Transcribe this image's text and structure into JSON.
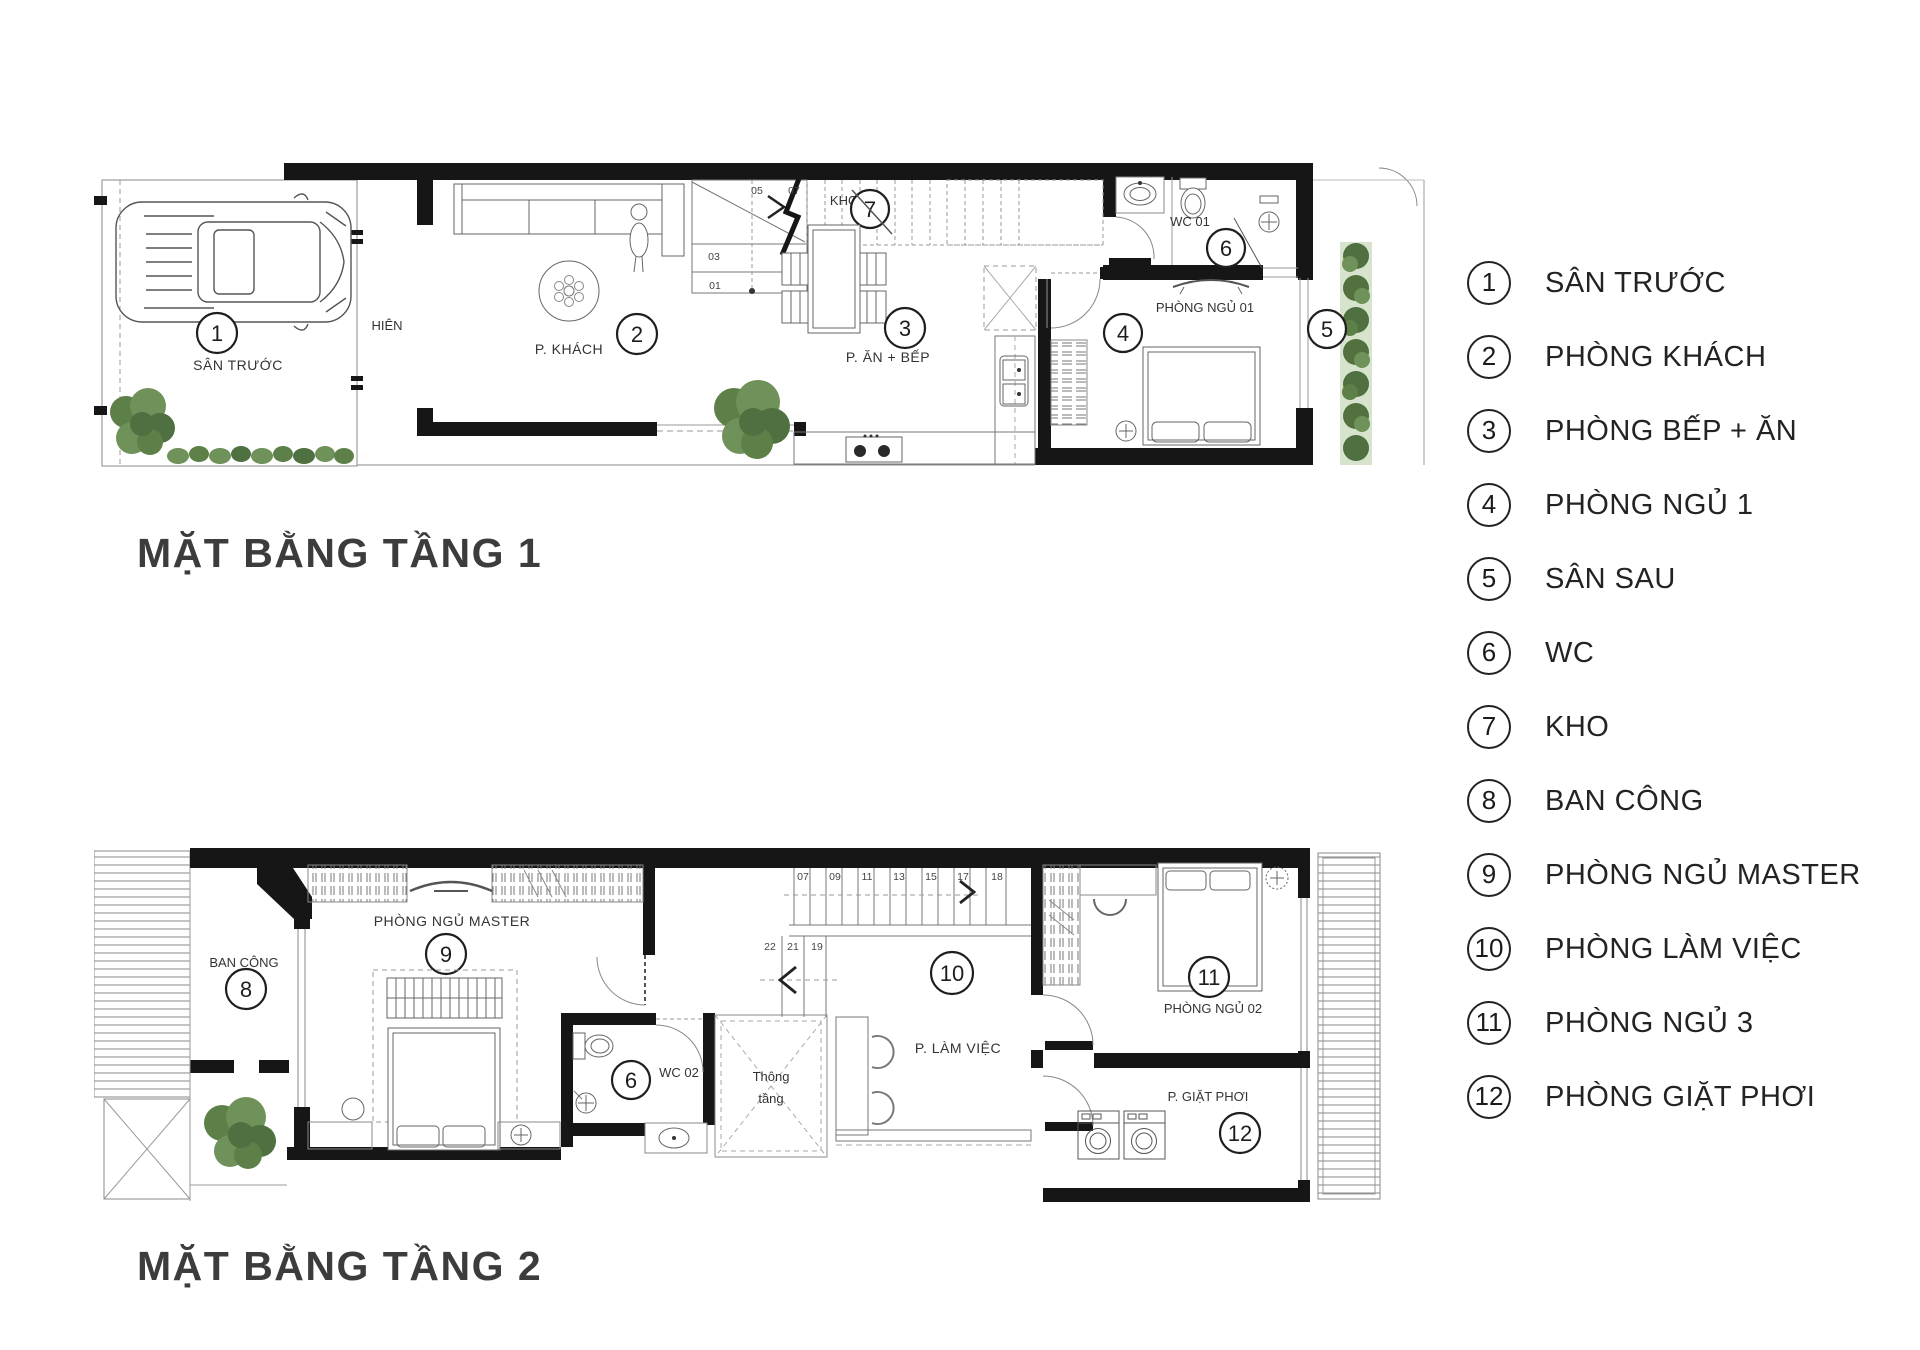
{
  "page": {
    "background": "#ffffff"
  },
  "colors": {
    "wall": "#161616",
    "line": "#6b6b6b",
    "plant_dark": "#4f7040",
    "plant_mid": "#5d8048",
    "plant_light": "#6f915a",
    "band": "#d8e3cd",
    "text": "#2f2f2f"
  },
  "floor1": {
    "title": "MẶT BẰNG TẦNG 1",
    "rooms": {
      "san_truoc": {
        "num": "1",
        "label": "SÂN TRƯỚC"
      },
      "hien": {
        "label": "HIÊN"
      },
      "khach": {
        "num": "2",
        "label": "P. KHÁCH"
      },
      "kho": {
        "num": "7",
        "label": "KHO"
      },
      "an_bep": {
        "num": "3",
        "label": "P. ĂN + BẾP"
      },
      "wc01": {
        "num": "6",
        "label": "WC 01"
      },
      "ngu01": {
        "num": "4",
        "label": "PHÒNG NGỦ 01"
      },
      "san_sau": {
        "num": "5"
      }
    },
    "stair_steps": [
      "01",
      "03",
      "05",
      "07"
    ]
  },
  "floor2": {
    "title": "MẶT BẰNG TẦNG 2",
    "rooms": {
      "ban_cong": {
        "num": "8",
        "label": "BAN CÔNG"
      },
      "ngu_master": {
        "num": "9",
        "label": "PHÒNG NGỦ MASTER"
      },
      "wc02": {
        "num": "6",
        "label": "WC 02"
      },
      "thong_tang": {
        "line1": "Thông",
        "line2": "tầng"
      },
      "lam_viec": {
        "num": "10",
        "label": "P. LÀM VIỆC"
      },
      "ngu02": {
        "num": "11",
        "label": "PHÒNG NGỦ 02"
      },
      "giat_phoi": {
        "num": "12",
        "label": "P. GIẶT PHƠI"
      }
    },
    "stair_steps_upper": [
      "07",
      "09",
      "11",
      "13",
      "15",
      "17",
      "18"
    ],
    "stair_steps_lower": [
      "22",
      "21",
      "19"
    ]
  },
  "legend": {
    "items": [
      {
        "num": "1",
        "label": "SÂN TRƯỚC"
      },
      {
        "num": "2",
        "label": "PHÒNG KHÁCH"
      },
      {
        "num": "3",
        "label": "PHÒNG BẾP + ĂN"
      },
      {
        "num": "4",
        "label": "PHÒNG NGỦ 1"
      },
      {
        "num": "5",
        "label": "SÂN SAU"
      },
      {
        "num": "6",
        "label": "WC"
      },
      {
        "num": "7",
        "label": "KHO"
      },
      {
        "num": "8",
        "label": "BAN CÔNG"
      },
      {
        "num": "9",
        "label": "PHÒNG NGỦ MASTER"
      },
      {
        "num": "10",
        "label": "PHÒNG LÀM VIỆC"
      },
      {
        "num": "11",
        "label": "PHÒNG NGỦ 3"
      },
      {
        "num": "12",
        "label": "PHÒNG GIẶT PHƠI"
      }
    ]
  }
}
